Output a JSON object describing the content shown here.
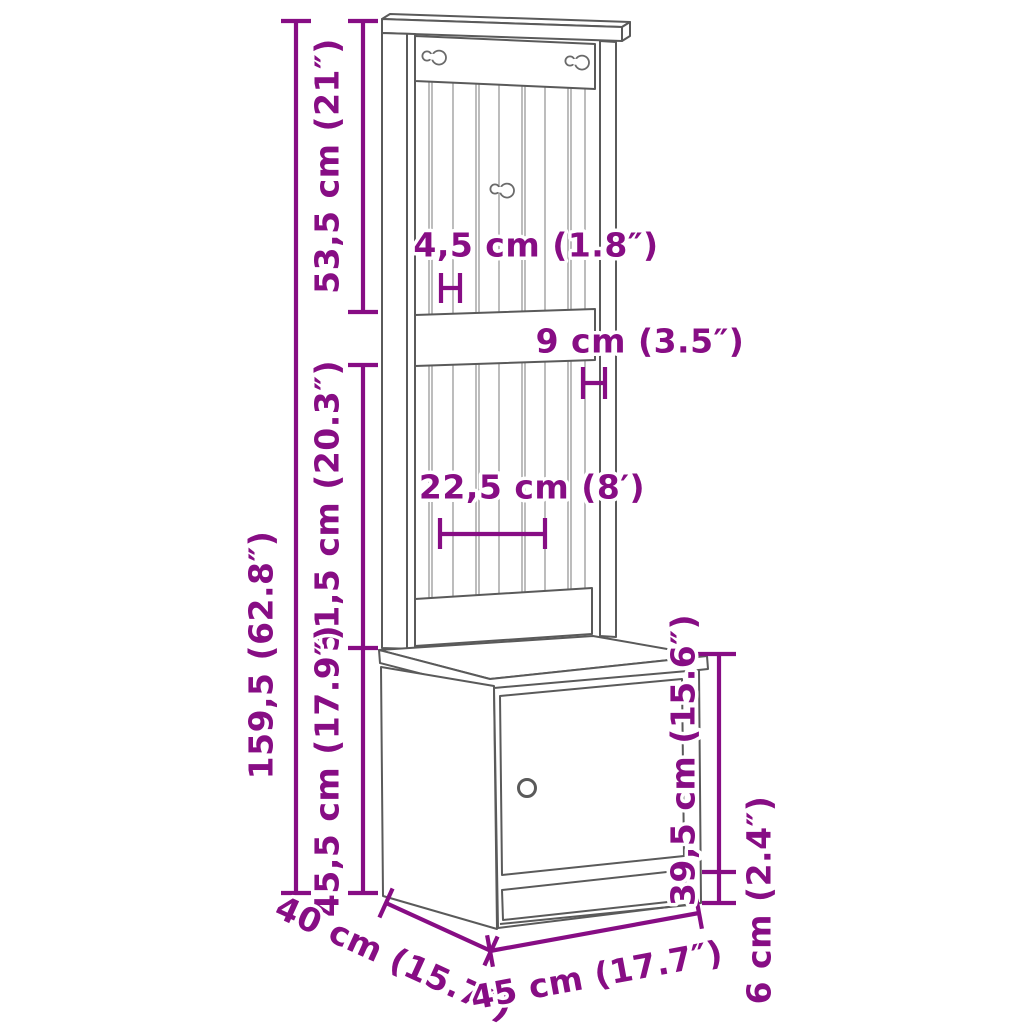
{
  "diagram": {
    "type": "product-dimension-line-drawing",
    "subject": "hall tree with coat hooks and storage cabinet",
    "background_color": "#ffffff"
  },
  "colors": {
    "dimension_annotation": "#870d84",
    "halo": "#ffffff",
    "outline": "#5a5a5a",
    "beadboard_lines": "#999999"
  },
  "dims": {
    "total_height": "159,5 (62.8″)",
    "top_section_height": "53,5 cm (21″)",
    "slat_spacing": "4,5 cm (1.8″)",
    "rail_height": "9 cm (3.5″)",
    "middle_section_height": "51,5 cm (20.3″)",
    "slat_span": "22,5 cm (8′)",
    "cabinet_height": "45,5 cm (17.9″)",
    "door_height": "39,5 cm (15.6″)",
    "plinth_height": "6 cm (2.4″)",
    "depth": "40 cm (15.7″)",
    "width": "45 cm (17.7″)"
  }
}
